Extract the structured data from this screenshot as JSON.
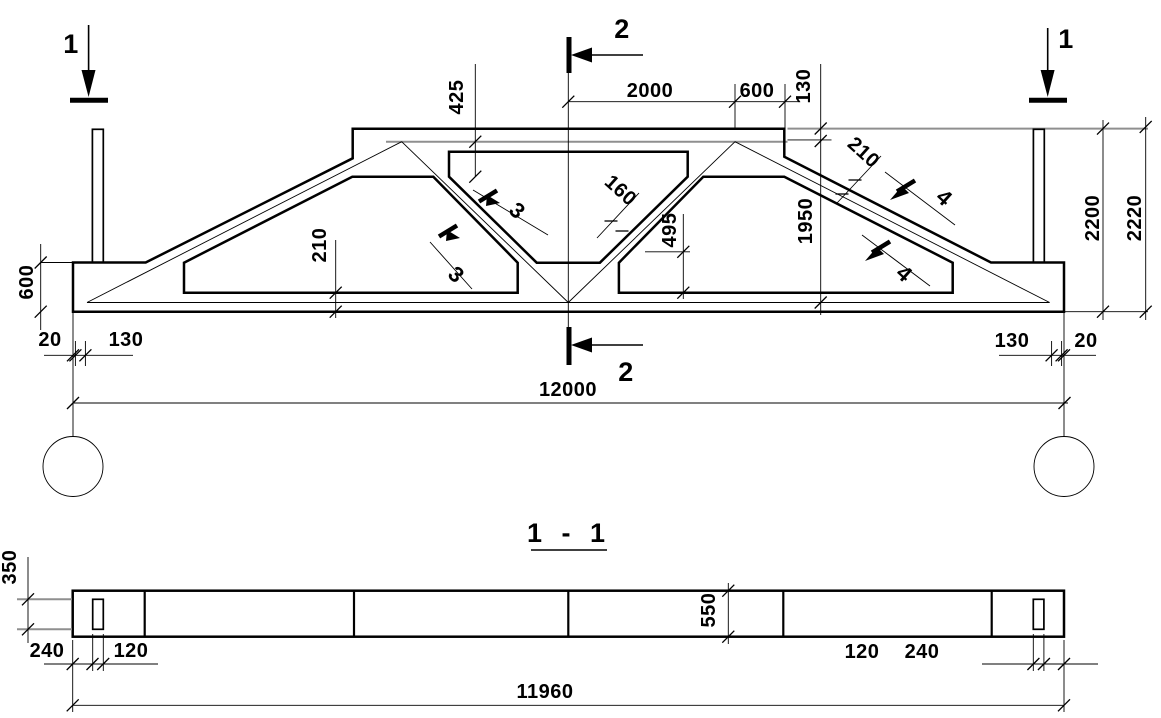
{
  "elevation": {
    "markers": {
      "section_1": "1",
      "section_2": "2",
      "section_3": "3",
      "section_4": "4"
    },
    "dims": {
      "half_top": "2000",
      "bearing": "600",
      "edge_offset": "130",
      "chord_end_depth": "425",
      "strut_thickness": "160",
      "end_diagonal_thickness": "210",
      "axis_height": "1950",
      "total_height": "2200",
      "overall_height": "2220",
      "support_block_height": "600",
      "bottom_chord_thickness": "210",
      "opening_edge_height": "495",
      "end_gap": "20",
      "support_offset": "130",
      "span": "12000"
    }
  },
  "section_1_1": {
    "title": "1 - 1",
    "dims": {
      "slot_height": "350",
      "end_margin": "240",
      "slot_width": "120",
      "beam_width": "550",
      "length": "11960"
    }
  }
}
